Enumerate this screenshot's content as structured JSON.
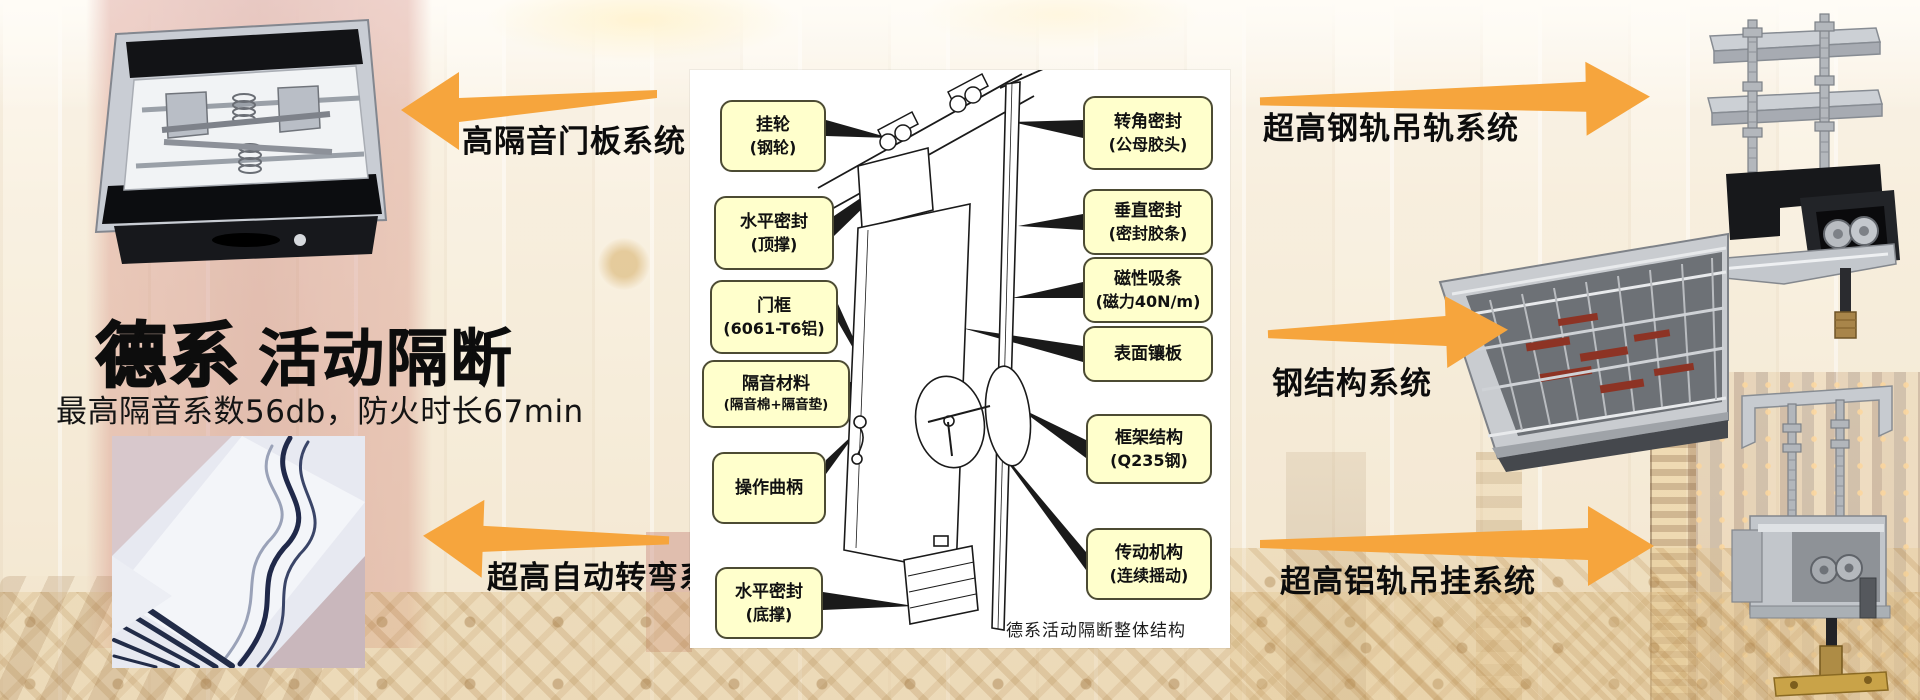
{
  "header": {
    "title_strong": "德系",
    "title_light": "活动隔断",
    "subtitle": "最高隔音系数56db，防火时长67min"
  },
  "system_labels": {
    "door_panel": "高隔音门板系统",
    "auto_turn": "超高自动转弯系统",
    "steel_rail": "超高钢轨吊轨系统",
    "steel_structure": "钢结构系统",
    "alu_rail": "超高铝轨吊挂系统"
  },
  "diagram": {
    "caption": "德系活动隔断整体结构",
    "callouts_left": [
      {
        "line1": "挂轮",
        "line2": "(钢轮)"
      },
      {
        "line1": "水平密封",
        "line2": "(顶撑)"
      },
      {
        "line1": "门框",
        "line2": "(6061-T6铝)"
      },
      {
        "line1": "隔音材料",
        "line2": "(隔音棉+隔音垫)"
      },
      {
        "line1": "操作曲柄",
        "line2": ""
      },
      {
        "line1": "水平密封",
        "line2": "(底撑)"
      }
    ],
    "callouts_right": [
      {
        "line1": "转角密封",
        "line2": "(公母胶头)"
      },
      {
        "line1": "垂直密封",
        "line2": "(密封胶条)"
      },
      {
        "line1": "磁性吸条",
        "line2": "(磁力40N/m)"
      },
      {
        "line1": "表面镶板",
        "line2": ""
      },
      {
        "line1": "框架结构",
        "line2": "(Q235钢)"
      },
      {
        "line1": "传动机构",
        "line2": "(连续摇动)"
      }
    ]
  },
  "photos": {
    "door_panel_mechanism": "door-panel-mechanism-photo",
    "curved_track": "curved-track-photo",
    "steel_rail_hanger": "steel-rail-hanger-photo",
    "steel_frame": "steel-frame-photo",
    "alu_rail_hanger": "aluminum-rail-hanger-photo"
  },
  "colors": {
    "arrow_orange": "#F6A53D",
    "callout_fill": "#FFFFCC",
    "callout_border": "#4C4B33",
    "panel_bg": "#FFFFFF"
  }
}
